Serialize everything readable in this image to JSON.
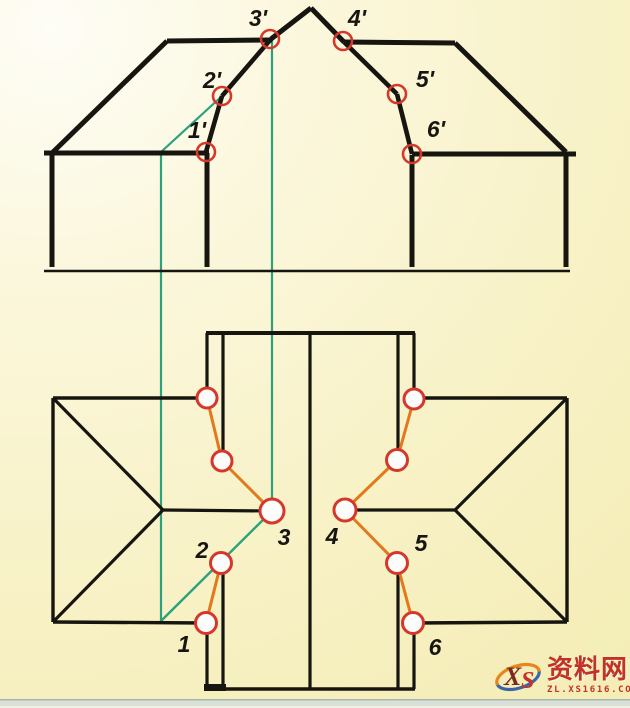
{
  "watermark": {
    "logo_x": "X",
    "logo_s": "S",
    "brand": "资料网",
    "site": "ZL.XS1616.COM"
  },
  "colors": {
    "ink": "#17150f",
    "teal": "#2ba17c",
    "orange": "#e2791a",
    "point_red": "#d6372b",
    "point_fill": "#fcfdfb",
    "label": "#17150f",
    "wm_red": "#c13227",
    "wm_blue": "#3a66a8",
    "wm_orange": "#e8861e"
  },
  "geometry": {
    "front_lines": [
      [
        44,
        271,
        570,
        271,
        2.4
      ],
      [
        52,
        153,
        52,
        267,
        5
      ],
      [
        44,
        153,
        209,
        153,
        5
      ],
      [
        52,
        153,
        167,
        41,
        5
      ],
      [
        167,
        41,
        272,
        40,
        5
      ],
      [
        311,
        8,
        271,
        39,
        5
      ],
      [
        271,
        39,
        222,
        96,
        4.6
      ],
      [
        222,
        96,
        206,
        152,
        4.6
      ],
      [
        207,
        153,
        207,
        267,
        5
      ],
      [
        311,
        8,
        344,
        42,
        5
      ],
      [
        344,
        42,
        397,
        94,
        4.6
      ],
      [
        397,
        94,
        412,
        154,
        4.6
      ],
      [
        344,
        42,
        455,
        43,
        5
      ],
      [
        455,
        43,
        566,
        152,
        5
      ],
      [
        412,
        154,
        576,
        154,
        5
      ],
      [
        566,
        154,
        566,
        267,
        5
      ],
      [
        412,
        155,
        412,
        267,
        5
      ]
    ],
    "plan_lines": [
      [
        206,
        333,
        415,
        333,
        4
      ],
      [
        206,
        689,
        415,
        689,
        3.4
      ],
      [
        204,
        687.5,
        226,
        687.5,
        7
      ],
      [
        207,
        333,
        207,
        392,
        3.2
      ],
      [
        207,
        629,
        207,
        689,
        3.2
      ],
      [
        223,
        333,
        223,
        453,
        3.2
      ],
      [
        223,
        570,
        223,
        689,
        3.2
      ],
      [
        310,
        333,
        310,
        689,
        3.2
      ],
      [
        398,
        333,
        398,
        452,
        3.2
      ],
      [
        398,
        570,
        398,
        689,
        3.2
      ],
      [
        414,
        333,
        414,
        392,
        3.2
      ],
      [
        414,
        630,
        414,
        689,
        3.2
      ],
      [
        53,
        398,
        53,
        622,
        3.4
      ],
      [
        53,
        398,
        207,
        398,
        3.4
      ],
      [
        53,
        622,
        206,
        623,
        3.4
      ],
      [
        53,
        398,
        163,
        510,
        3.2
      ],
      [
        53,
        622,
        163,
        510,
        3.2
      ],
      [
        163,
        510,
        272,
        511,
        3.2
      ],
      [
        567,
        398,
        567,
        622,
        3.4
      ],
      [
        414,
        398,
        567,
        398,
        3.4
      ],
      [
        413,
        623,
        567,
        622,
        3.4
      ],
      [
        567,
        398,
        455,
        510,
        3.2
      ],
      [
        567,
        622,
        455,
        510,
        3.2
      ],
      [
        345,
        510,
        455,
        510,
        3.2
      ]
    ],
    "construction_lines": [
      [
        161,
        152,
        161,
        621,
        2.2
      ],
      [
        272,
        40,
        272,
        511,
        2.2
      ],
      [
        161,
        152,
        222,
        96,
        2.2
      ],
      [
        161,
        621,
        272,
        511,
        2.4
      ]
    ],
    "intersection_lines": [
      [
        207,
        398,
        222,
        461,
        3
      ],
      [
        222,
        461,
        272,
        511,
        3
      ],
      [
        221,
        563,
        206,
        623,
        3
      ],
      [
        414,
        399,
        397,
        460,
        3
      ],
      [
        397,
        460,
        345,
        510,
        3
      ],
      [
        345,
        510,
        397,
        563,
        3
      ],
      [
        397,
        563,
        413,
        623,
        3
      ]
    ],
    "front_points": [
      [
        206,
        152,
        9
      ],
      [
        222,
        96,
        9
      ],
      [
        270,
        39,
        9
      ],
      [
        343,
        41,
        9
      ],
      [
        397,
        94,
        9
      ],
      [
        412,
        154,
        9
      ]
    ],
    "plan_points": [
      [
        207,
        398,
        10
      ],
      [
        222,
        461,
        10
      ],
      [
        272,
        511,
        12
      ],
      [
        221,
        563,
        10.5
      ],
      [
        206,
        623,
        10.5
      ],
      [
        414,
        399,
        10
      ],
      [
        397,
        460,
        10.5
      ],
      [
        345,
        510,
        11
      ],
      [
        397,
        563,
        10.5
      ],
      [
        413,
        623,
        10.5
      ]
    ],
    "front_labels": [
      [
        "1'",
        197,
        138
      ],
      [
        "2'",
        212,
        88
      ],
      [
        "3'",
        258,
        26
      ],
      [
        "4'",
        357,
        26
      ],
      [
        "5'",
        425,
        87
      ],
      [
        "6'",
        436,
        137
      ]
    ],
    "plan_labels": [
      [
        "1",
        184,
        652
      ],
      [
        "2",
        202,
        558
      ],
      [
        "3",
        284,
        545
      ],
      [
        "4",
        332,
        544
      ],
      [
        "5",
        421,
        551
      ],
      [
        "6",
        435,
        655
      ]
    ]
  }
}
